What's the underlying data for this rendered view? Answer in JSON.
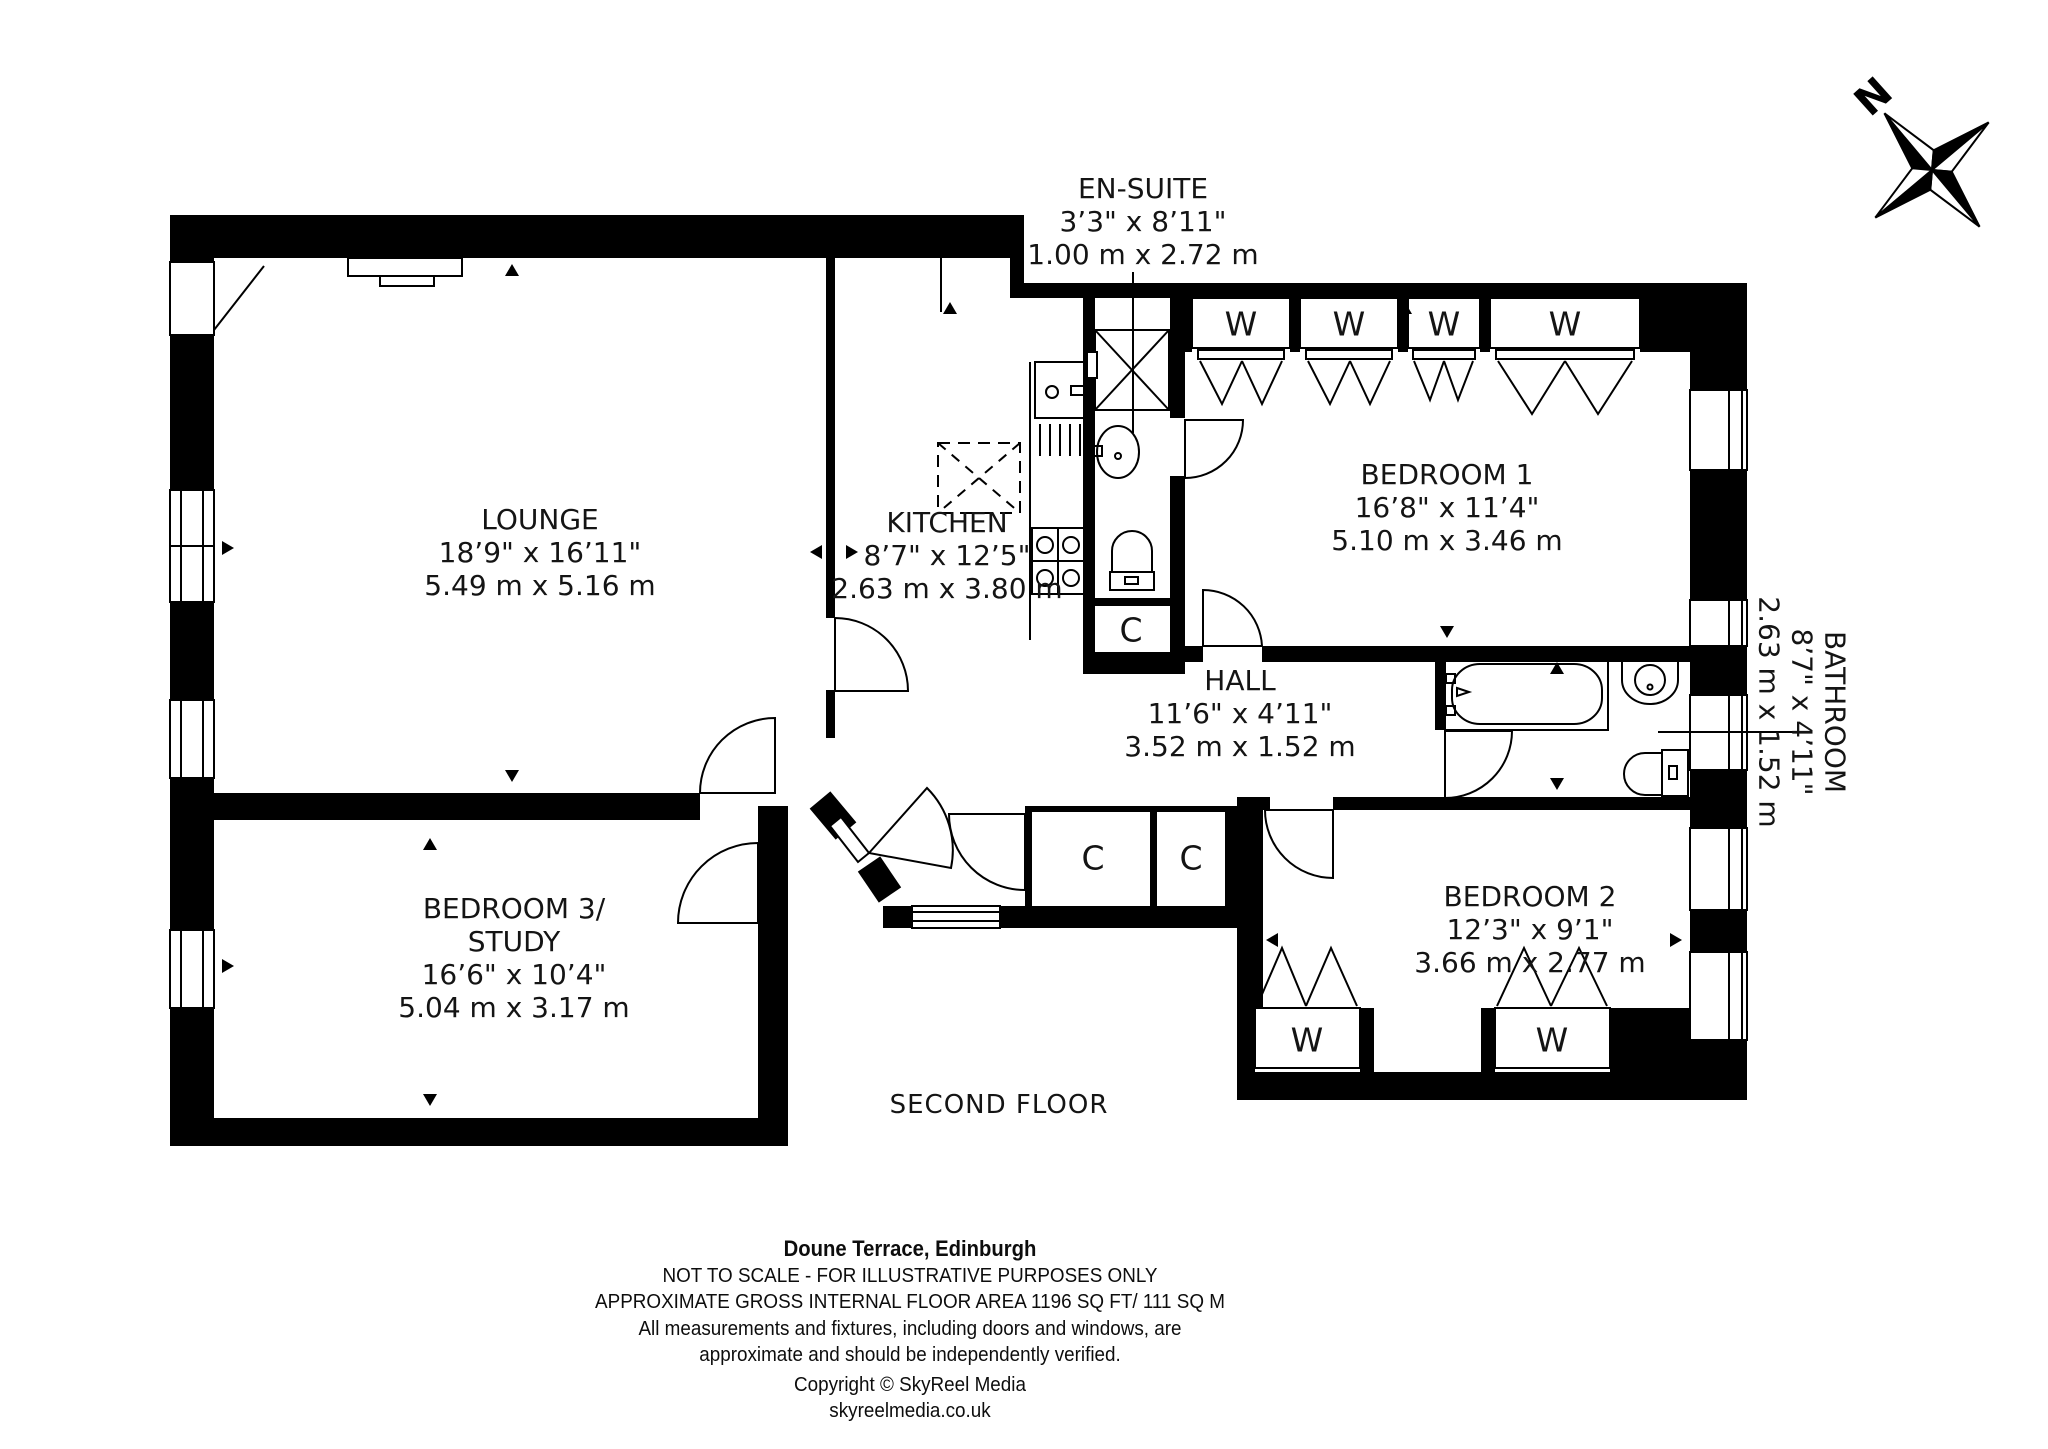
{
  "compass": {
    "north_label": "N"
  },
  "floor_label": "SECOND FLOOR",
  "rooms": [
    {
      "id": "lounge",
      "name": "LOUNGE",
      "name2": "",
      "imperial": "18’9\" x 16’11\"",
      "metric": "5.49 m x 5.16 m"
    },
    {
      "id": "kitchen",
      "name": "KITCHEN",
      "name2": "",
      "imperial": "8’7\" x 12’5\"",
      "metric": "2.63 m x 3.80 m"
    },
    {
      "id": "ensuite",
      "name": "EN-SUITE",
      "name2": "",
      "imperial": "3’3\" x 8’11\"",
      "metric": "1.00 m x 2.72 m"
    },
    {
      "id": "bedroom1",
      "name": "BEDROOM 1",
      "name2": "",
      "imperial": "16’8\" x 11’4\"",
      "metric": "5.10 m x 3.46 m"
    },
    {
      "id": "hall",
      "name": "HALL",
      "name2": "",
      "imperial": "11’6\" x 4’11\"",
      "metric": "3.52 m x 1.52 m"
    },
    {
      "id": "bathroom",
      "name": "BATHROOM",
      "name2": "",
      "imperial": "8’7\" x 4’11\"",
      "metric": "2.63 m x 1.52 m"
    },
    {
      "id": "bedroom2",
      "name": "BEDROOM 2",
      "name2": "",
      "imperial": "12’3\" x 9’1\"",
      "metric": "3.66 m x 2.77 m"
    },
    {
      "id": "bedroom3",
      "name": "BEDROOM 3/",
      "name2": "STUDY",
      "imperial": "16’6\" x 10’4\"",
      "metric": "5.04 m x 3.17 m"
    }
  ],
  "closets": {
    "cupboard_label": "C",
    "wardrobe_label": "W"
  },
  "footer": {
    "title": "Doune Terrace, Edinburgh",
    "line2": "NOT TO SCALE - FOR ILLUSTRATIVE PURPOSES ONLY",
    "line3": "APPROXIMATE GROSS INTERNAL FLOOR AREA 1196 SQ FT/ 111 SQ M",
    "line4": "All measurements and fixtures, including doors and windows, are",
    "line5": "approximate and should be independently verified.",
    "line6": "Copyright © SkyReel Media",
    "line7": "skyreelmedia.co.uk"
  },
  "colors": {
    "wall": "#000000",
    "background": "#ffffff",
    "text": "#141414"
  }
}
